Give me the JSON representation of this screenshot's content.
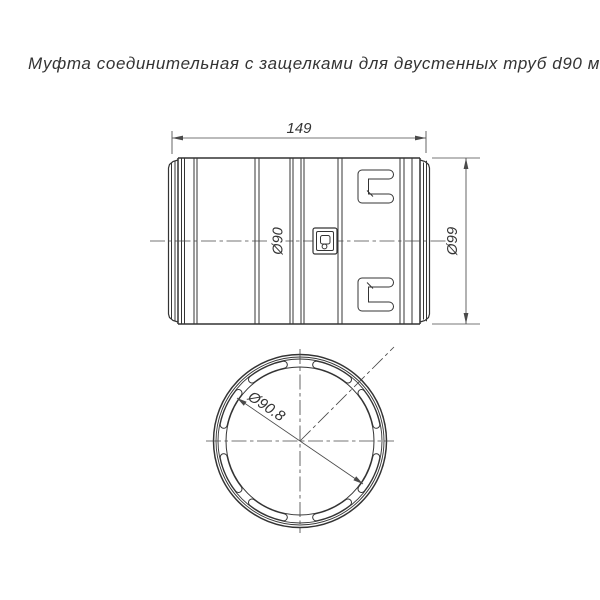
{
  "title": "Муфта соединительная с защелками для двустенных труб d90 мм",
  "side_view": {
    "length_label": "149",
    "outer_diameter_label": "Ø99",
    "body_diameter_label": "Ø90"
  },
  "end_view": {
    "inner_diameter_label": "Ø90.8",
    "slot_count": 8
  },
  "icons": {
    "latch_window_icon": "brand-latch-icon"
  },
  "colors": {
    "line": "#343434",
    "dimension": "#4a4a4a",
    "background": "#ffffff"
  }
}
